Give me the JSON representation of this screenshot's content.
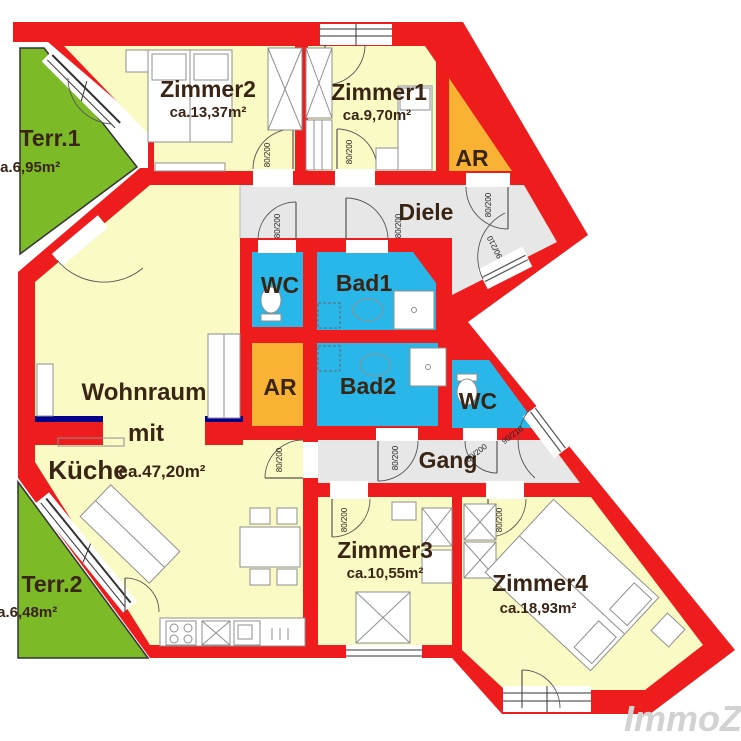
{
  "plan": {
    "watermark": "ImmoZ",
    "door_labels": {
      "standard": "80/200",
      "entrance": "90/210"
    },
    "colors": {
      "wall": "#ee1c1c",
      "room": "#fafac5",
      "wet": "#29b7ea",
      "storage": "#f9b233",
      "terrace": "#7cba28",
      "corridor": "#e7e7e7",
      "window_accent": "#00008b"
    },
    "rooms": [
      {
        "id": "terr1",
        "label": "Terr.1",
        "area": "ca.6,95m²"
      },
      {
        "id": "zimmer2",
        "label": "Zimmer2",
        "area": "ca.13,37m²"
      },
      {
        "id": "zimmer1",
        "label": "Zimmer1",
        "area": "ca.9,70m²"
      },
      {
        "id": "ar1",
        "label": "AR"
      },
      {
        "id": "diele",
        "label": "Diele"
      },
      {
        "id": "wc1",
        "label": "WC"
      },
      {
        "id": "bad1",
        "label": "Bad1"
      },
      {
        "id": "wohnraum",
        "label_line1": "Wohnraum",
        "label_line2": "mit",
        "label_line3": "Küche",
        "area": "ca.47,20m²"
      },
      {
        "id": "ar2",
        "label": "AR"
      },
      {
        "id": "bad2",
        "label": "Bad2"
      },
      {
        "id": "wc2",
        "label": "WC"
      },
      {
        "id": "gang",
        "label": "Gang"
      },
      {
        "id": "zimmer3",
        "label": "Zimmer3",
        "area": "ca.10,55m²"
      },
      {
        "id": "zimmer4",
        "label": "Zimmer4",
        "area": "ca.18,93m²"
      },
      {
        "id": "terr2",
        "label": "Terr.2",
        "area": "ca.6,48m²"
      }
    ]
  }
}
